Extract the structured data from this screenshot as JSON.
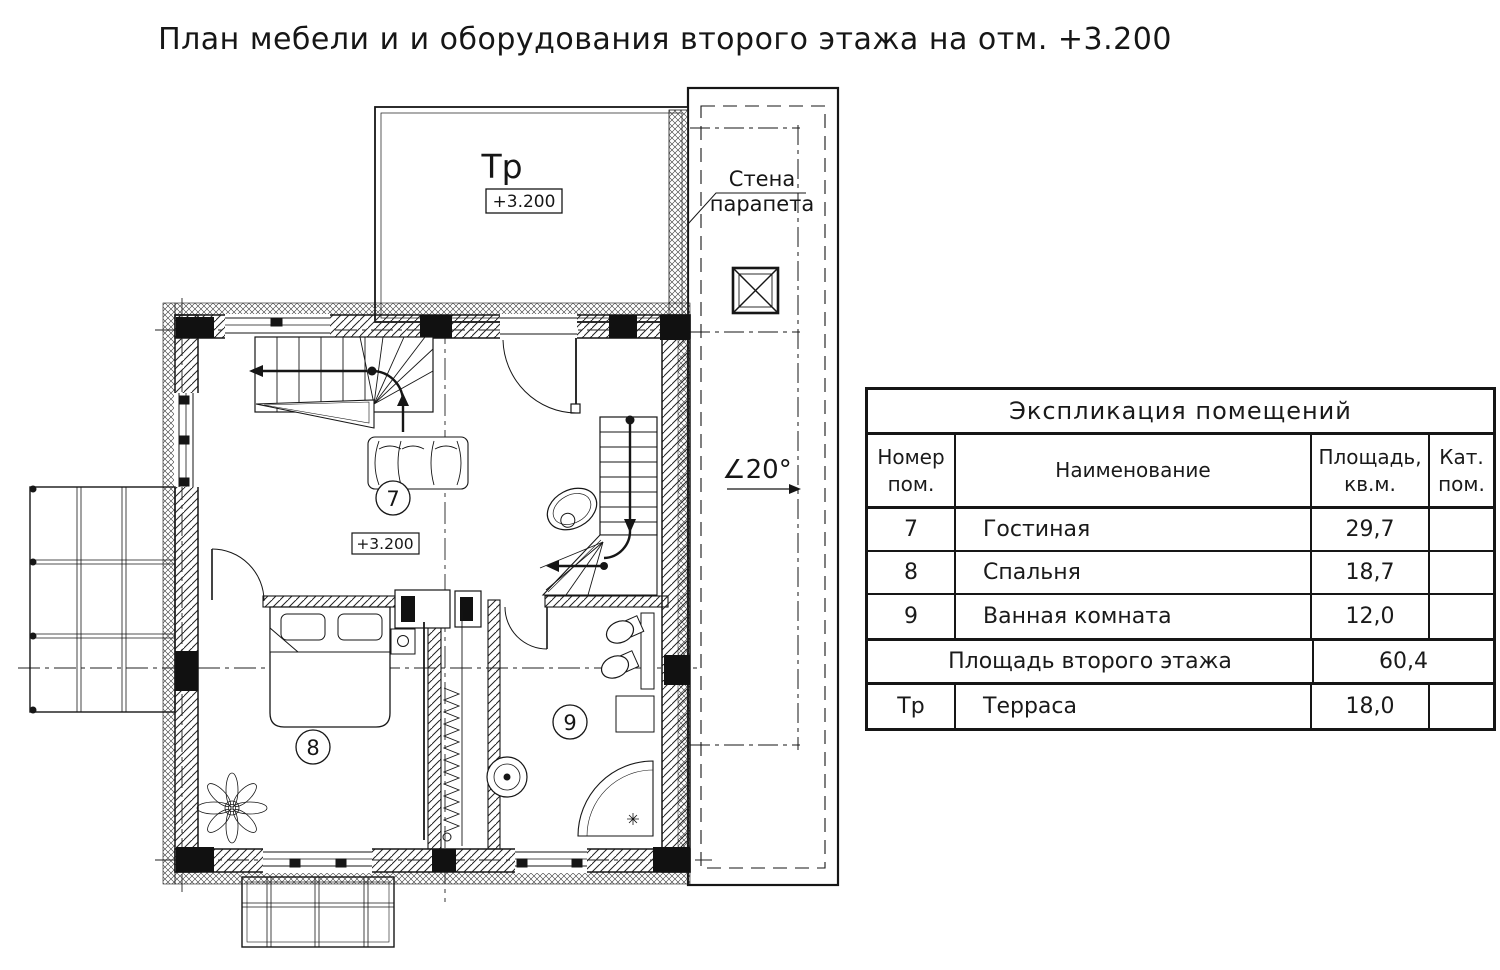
{
  "page": {
    "title": "План мебели и и оборудования второго этажа на отм. +3.200"
  },
  "plan": {
    "terrace": {
      "label": "Тр",
      "elevation": "+3.200"
    },
    "parapet_note": {
      "line1": "Стена",
      "line2": "парапета"
    },
    "roof_slope": "∠20°",
    "living_room": {
      "number": "7",
      "elevation": "+3.200"
    },
    "bedroom": {
      "number": "8"
    },
    "bathroom": {
      "number": "9"
    }
  },
  "schedule": {
    "title": "Экспликация помещений",
    "headers": {
      "num_l1": "Номер",
      "num_l2": "пом.",
      "name": "Наименование",
      "area_l1": "Площадь,",
      "area_l2": "кв.м.",
      "cat_l1": "Кат.",
      "cat_l2": "пом."
    },
    "rows": [
      {
        "num": "7",
        "name": "Гостиная",
        "area": "29,7",
        "cat": ""
      },
      {
        "num": "8",
        "name": "Спальня",
        "area": "18,7",
        "cat": ""
      },
      {
        "num": "9",
        "name": "Ванная комната",
        "area": "12,0",
        "cat": ""
      }
    ],
    "summary": {
      "label": "Площадь второго этажа",
      "area": "60,4"
    },
    "terrace_row": {
      "num": "Тр",
      "name": "Терраса",
      "area": "18,0",
      "cat": ""
    }
  },
  "colors": {
    "ink": "#1a1a1a",
    "paper": "#ffffff"
  }
}
